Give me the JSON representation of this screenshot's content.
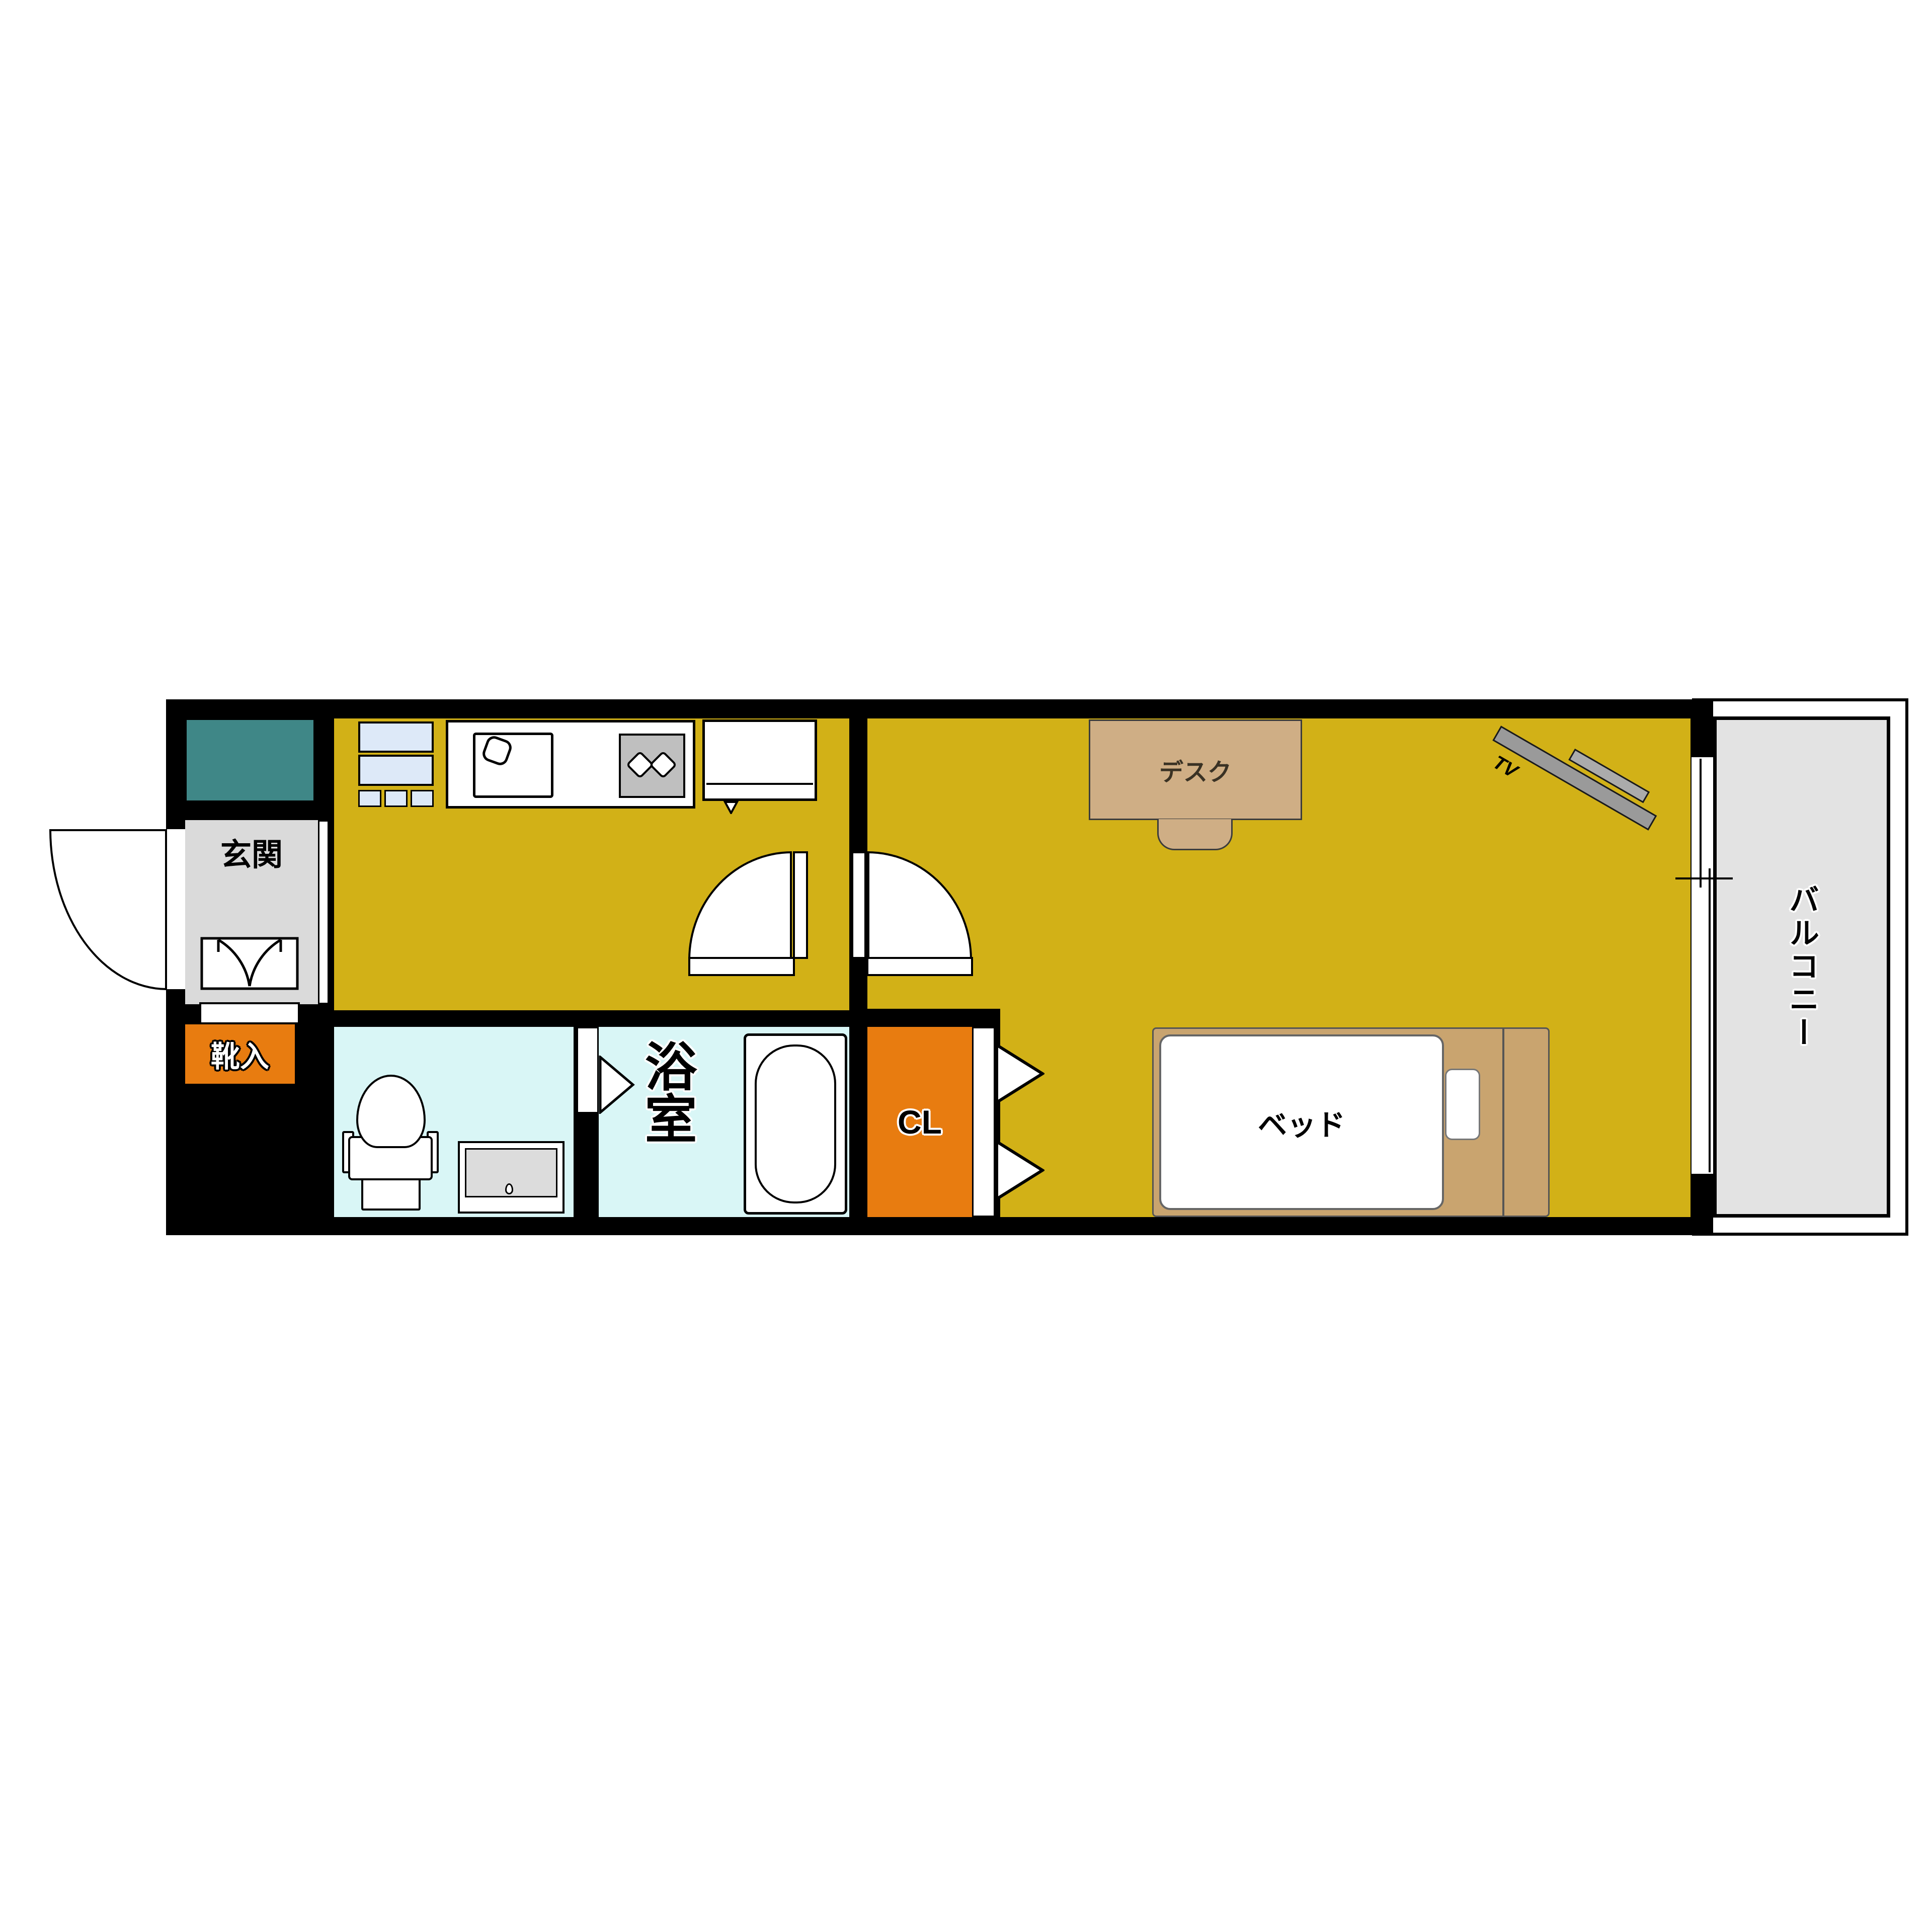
{
  "floorplan": {
    "rooms": {
      "entrance": {
        "label": "玄関"
      },
      "shoe_cabinet": {
        "label": "靴入"
      },
      "bathroom": {
        "label": "浴室"
      },
      "closet": {
        "label": "CL"
      },
      "balcony": {
        "label": "バルコニー"
      }
    },
    "furniture": {
      "desk": {
        "label": "デスク"
      },
      "bed": {
        "label": "ベッド"
      },
      "tv": {
        "label": "TV"
      }
    },
    "colors": {
      "floor_yellow": "#d2b117",
      "accent_orange": "#e87c10",
      "wet_cyan": "#d9f6f6",
      "entry_gray": "#dadada",
      "balcony_gray": "#e3e3e3",
      "teal": "#3f8787",
      "furniture_tan": "#c9a46f",
      "desk_tan": "#cfae85",
      "cabinet_blue": "#dde9f8",
      "wall_black": "#000000"
    }
  }
}
